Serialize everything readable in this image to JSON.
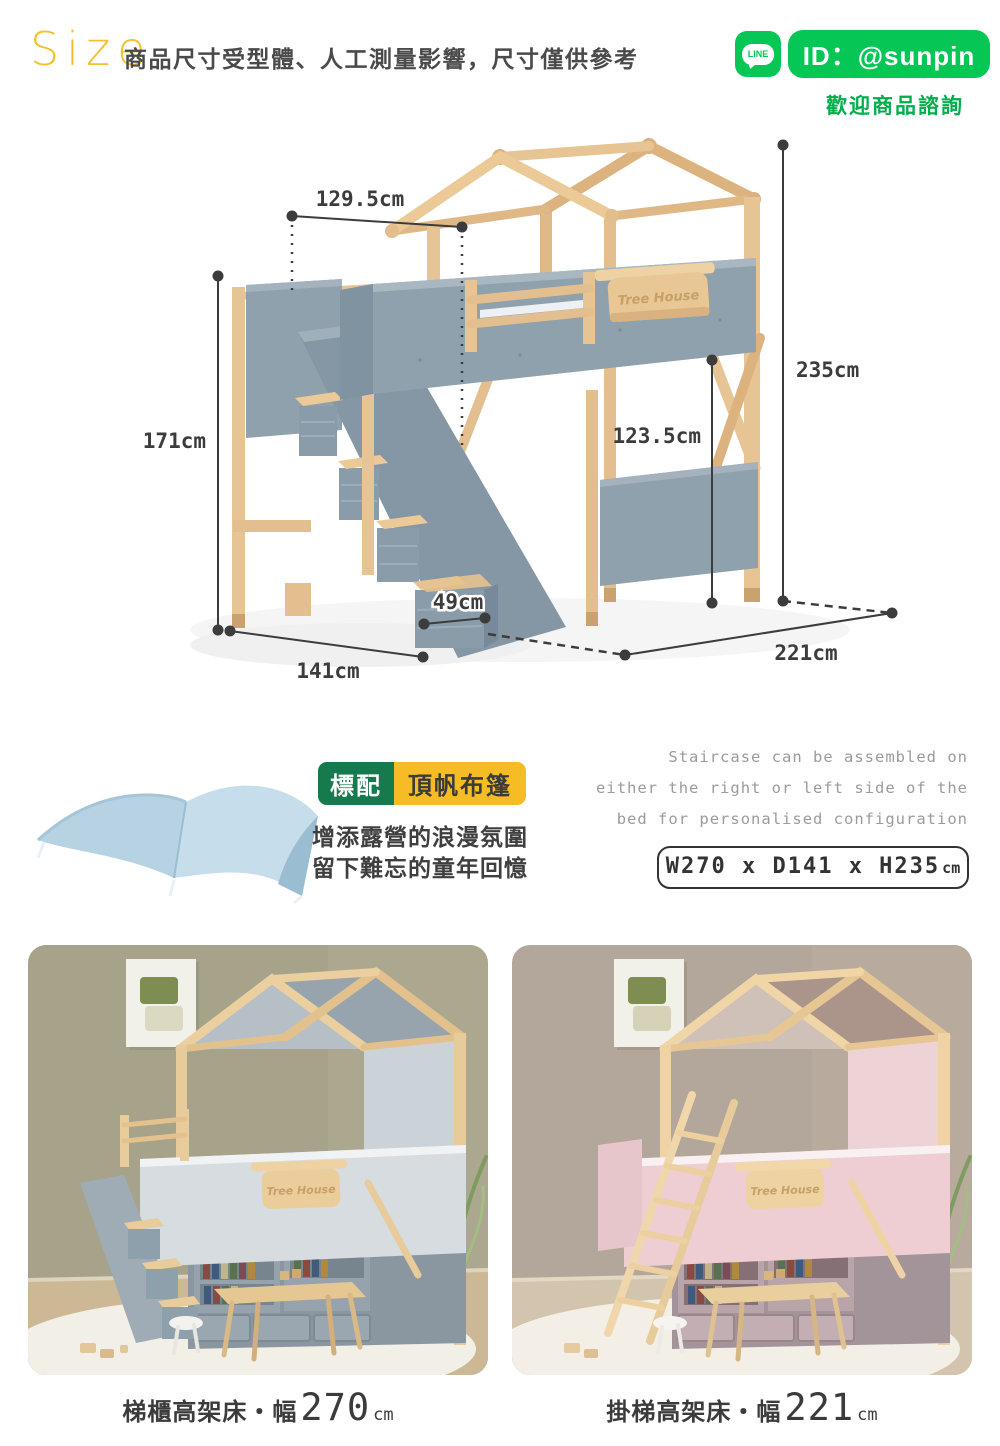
{
  "header": {
    "title": "Size",
    "subtitle": "商品尺寸受型體、人工測量影響，尺寸僅供參考",
    "line_contact": {
      "icon_text": "LINE",
      "id_text": "ID：@sunpin",
      "welcome_text": "歡迎商品諮詢",
      "brand_green": "#06C755",
      "welcome_green": "#00AF4C"
    }
  },
  "diagram": {
    "sign_label": "Tree House",
    "dimensions": {
      "bed_top_width": "129.5cm",
      "stair_side_height": "171cm",
      "total_height": "235cm",
      "under_bed_clearance": "123.5cm",
      "step_depth": "49cm",
      "base_depth": "141cm",
      "base_width": "221cm"
    },
    "colors": {
      "wood": "#E7C795",
      "panel_gray": "#8FA1AD",
      "dim_line": "#3C3C3C"
    }
  },
  "canopy_section": {
    "badge_standard": "標配",
    "badge_item": "頂帆布篷",
    "desc_line1": "增添露營的浪漫氛圍",
    "desc_line2": "留下難忘的童年回憶",
    "badge_green": "#17794E",
    "badge_yellow": "#F5BC25"
  },
  "staircase_note": {
    "line1": "Staircase can be assembled on",
    "line2": "either the right or left side of the",
    "line3": "bed for personalised configuration",
    "size_value": "W270 x D141 x H235",
    "size_unit": "cm"
  },
  "gallery": {
    "left": {
      "sign_label": "Tree House",
      "caption_name": "梯櫃高架床・幅",
      "caption_value": "270",
      "caption_unit": "cm"
    },
    "right": {
      "sign_label": "Tree House",
      "caption_name": "掛梯高架床・幅",
      "caption_value": "221",
      "caption_unit": "cm"
    }
  }
}
